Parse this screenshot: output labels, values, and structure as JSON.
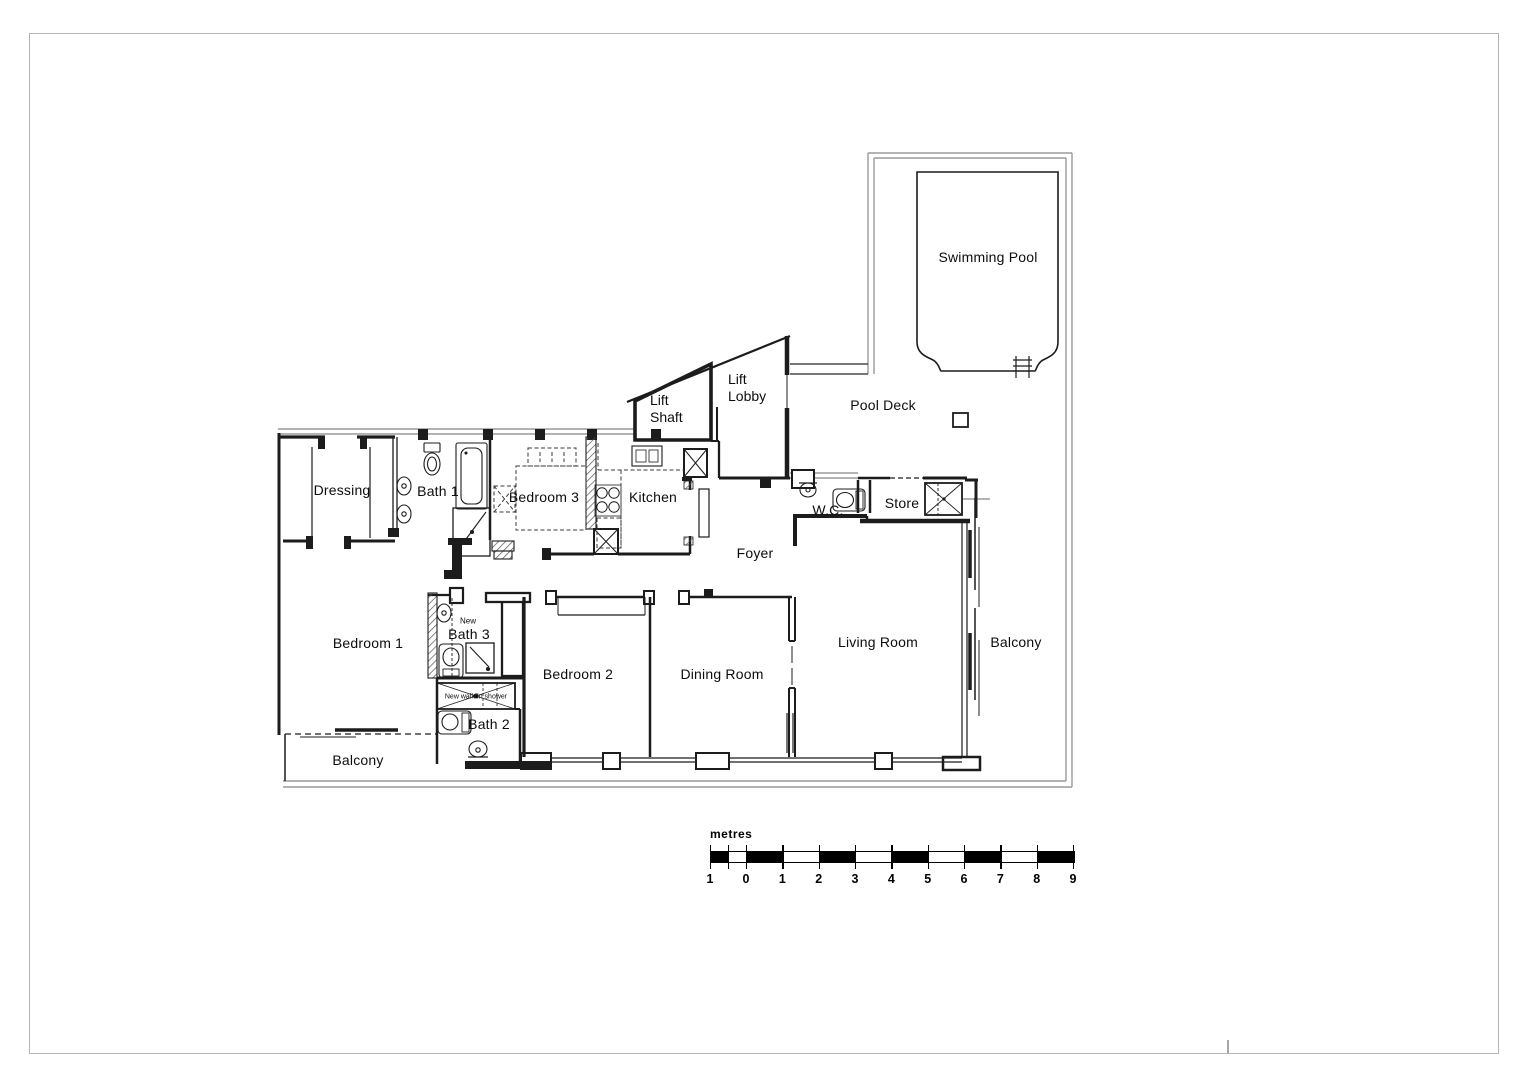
{
  "rooms": {
    "swimming_pool": "Swimming Pool",
    "pool_deck": "Pool Deck",
    "lift_shaft": {
      "line1": "Lift",
      "line2": "Shaft"
    },
    "lift_lobby": {
      "line1": "Lift",
      "line2": "Lobby"
    },
    "dressing": "Dressing",
    "bath_1": "Bath 1",
    "bedroom_3": "Bedroom 3",
    "kitchen": "Kitchen",
    "wc": "W.C.",
    "store": "Store",
    "foyer": "Foyer",
    "bedroom_1": "Bedroom 1",
    "bath_3": "Bath 3",
    "bath_2": "Bath 2",
    "bedroom_2": "Bedroom 2",
    "dining_room": "Dining Room",
    "living_room": "Living Room",
    "balcony_left": "Balcony",
    "balcony_right": "Balcony"
  },
  "annotations": {
    "new_marker": "New",
    "walk_in_shower": "New walk-in shower"
  },
  "scalebar": {
    "unit": "metres",
    "ticks": [
      "1",
      "0",
      "1",
      "2",
      "3",
      "4",
      "5",
      "6",
      "7",
      "8",
      "9"
    ]
  },
  "colors": {
    "new_wall": "#1c1c1c",
    "existing_wall": "#9a9a9a",
    "page_border": "#b5b5b5",
    "background": "#ffffff"
  }
}
